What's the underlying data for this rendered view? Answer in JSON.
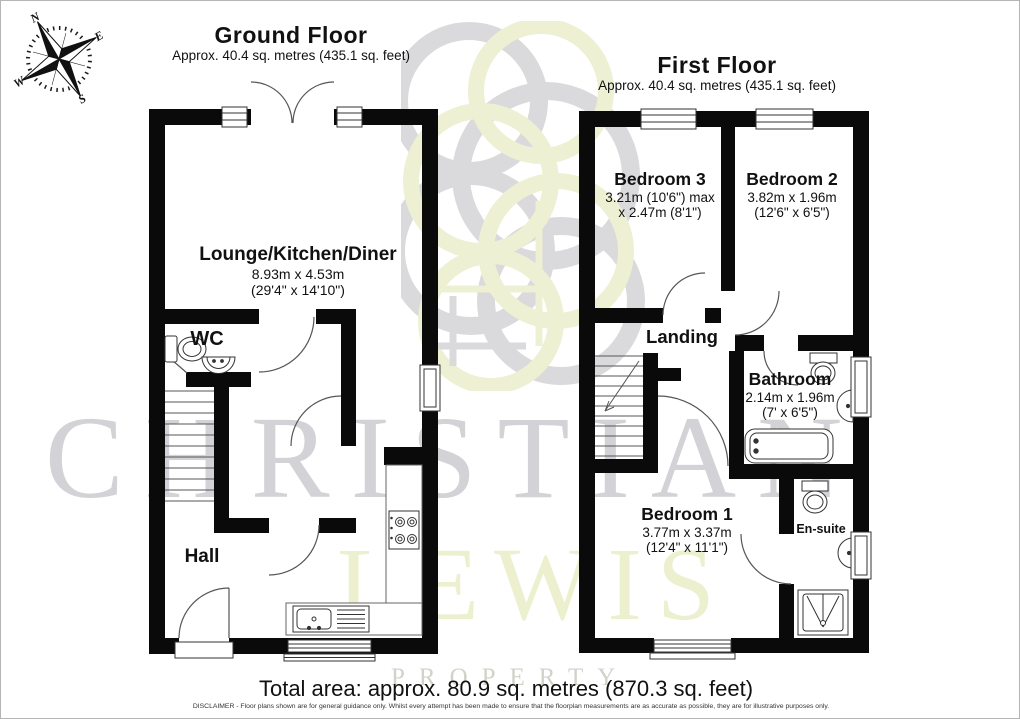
{
  "compass": {
    "n": "N",
    "e": "E",
    "s": "S",
    "w": "W"
  },
  "ground_floor": {
    "title": "Ground Floor",
    "subtitle": "Approx. 40.4 sq. metres (435.1 sq. feet)",
    "rooms": {
      "lounge": {
        "name": "Lounge/Kitchen/Diner",
        "dims_metric": "8.93m x 4.53m",
        "dims_imperial": "(29'4\" x 14'10\")"
      },
      "wc": {
        "name": "WC"
      },
      "hall": {
        "name": "Hall"
      }
    }
  },
  "first_floor": {
    "title": "First Floor",
    "subtitle": "Approx. 40.4 sq. metres (435.1 sq. feet)",
    "rooms": {
      "bedroom3": {
        "name": "Bedroom 3",
        "dims_metric": "3.21m (10'6\") max",
        "dims_imperial": "x 2.47m (8'1\")"
      },
      "bedroom2": {
        "name": "Bedroom 2",
        "dims_metric": "3.82m x 1.96m",
        "dims_imperial": "(12'6\" x 6'5\")"
      },
      "landing": {
        "name": "Landing"
      },
      "bathroom": {
        "name": "Bathroom",
        "dims_metric": "2.14m x 1.96m",
        "dims_imperial": "(7' x 6'5\")"
      },
      "bedroom1": {
        "name": "Bedroom 1",
        "dims_metric": "3.77m x 3.37m",
        "dims_imperial": "(12'4\" x 11'1\")"
      },
      "ensuite": {
        "name": "En-suite"
      }
    }
  },
  "footer": {
    "total_area": "Total area: approx. 80.9 sq. metres (870.3 sq. feet)",
    "disclaimer": "DISCLAIMER -  Floor plans shown are for general guidance only. Whilst every attempt has been made to ensure that the floorplan measurements are as accurate as possible, they are for illustrative purposes only."
  },
  "watermark": {
    "line1": "CHRISTIAN",
    "line2": "LEWIS",
    "line3": "PROPERTY"
  },
  "colors": {
    "wall": "#0a0a0a",
    "watermark_gray": "#d3d3d7",
    "watermark_yellow": "#edf0cf"
  }
}
